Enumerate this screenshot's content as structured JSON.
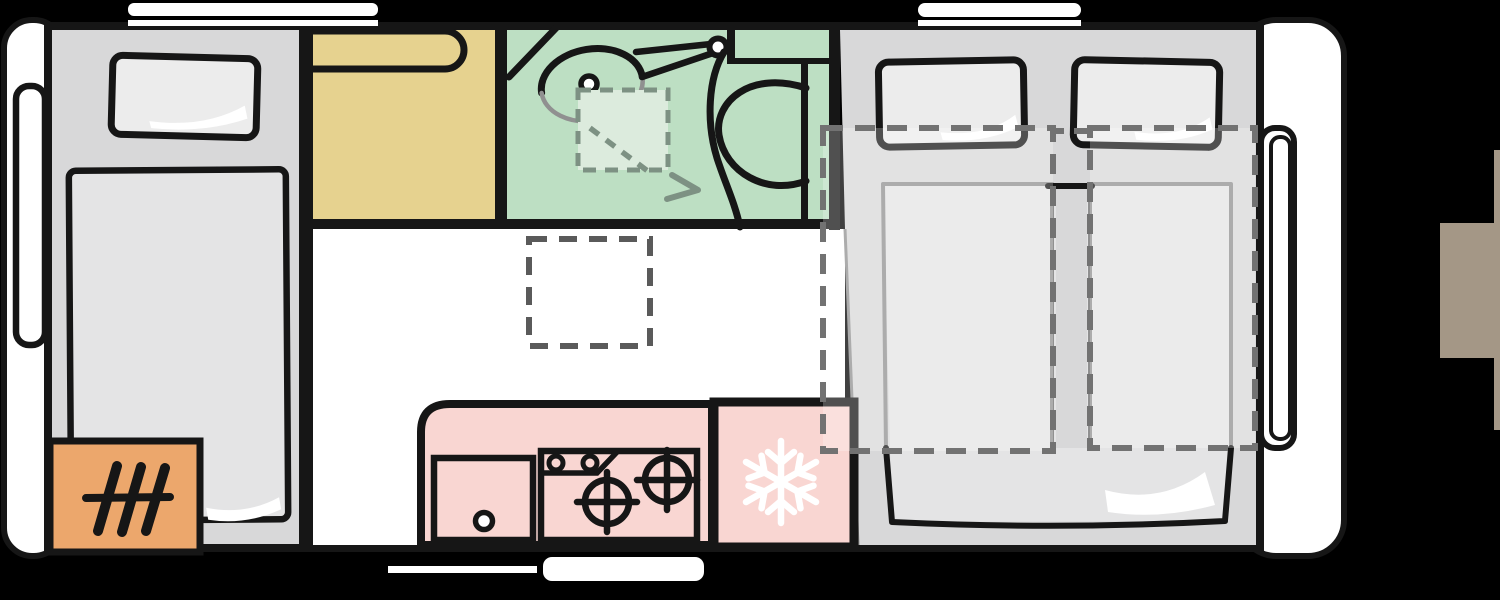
{
  "app": {
    "name": "caravan-floorplan-viewer",
    "view_label": "Caravan floor plan, top view"
  },
  "colors": {
    "background": "#000000",
    "outline": "#161616",
    "body_white": "#ffffff",
    "floor_white": "#ffffff",
    "bedroom_gray": "#d8d8d9",
    "mattress_gray": "#e4e4e5",
    "pillow_gray": "#ececec",
    "sketch_gray": "#909090",
    "wardrobe_yellow": "#e6d28f",
    "bathroom_green": "#bddfc3",
    "shower_tray_green": "#dcebdd",
    "kitchen_pink": "#f9d6d2",
    "heater_orange": "#eca76c",
    "dash_dark": "#5a5a5a",
    "dash_mid": "#727272",
    "dash_green": "#7d9183",
    "side_tab_brown": "#a49786",
    "snowflake_white": "#ffffff",
    "highlight_white": "#ffffff"
  },
  "floorplan": {
    "vehicle": "caravan",
    "zones": [
      {
        "id": "front-bedroom",
        "label": "front single bed with pillow",
        "color_key": "bedroom_gray"
      },
      {
        "id": "heater",
        "label": "heater unit",
        "color_key": "heater_orange"
      },
      {
        "id": "wardrobe",
        "label": "wardrobe bench",
        "color_key": "wardrobe_yellow"
      },
      {
        "id": "bathroom",
        "label": "washroom with swivel basin, shower tray and toilet",
        "color_key": "bathroom_green"
      },
      {
        "id": "living",
        "label": "living area with table outline",
        "color_key": "floor_white"
      },
      {
        "id": "kitchen",
        "label": "kitchen with sink and two-burner hob",
        "color_key": "kitchen_pink"
      },
      {
        "id": "fridge",
        "label": "fridge freezer compartment",
        "color_key": "kitchen_pink"
      },
      {
        "id": "rear-bedroom",
        "label": "rear twin single beds with pull-out extensions",
        "color_key": "bedroom_gray"
      }
    ],
    "features": [
      "front-window",
      "roof-window-front",
      "roof-window-rear",
      "rear-side-window",
      "entry-step",
      "underbody-rail",
      "snowflake-icon",
      "shower-arrow",
      "bed-extension-outline"
    ]
  }
}
